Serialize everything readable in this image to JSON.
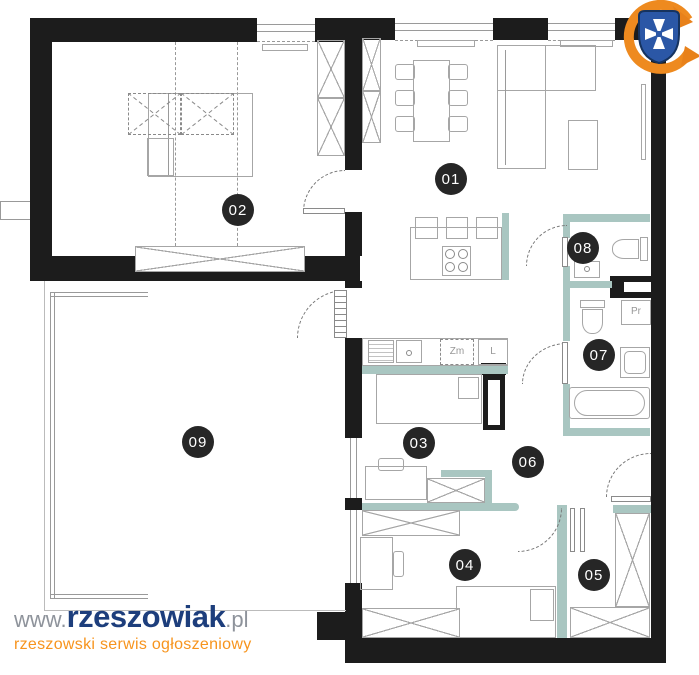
{
  "branding": {
    "www_prefix": "www.",
    "site_name": "rzeszowiak",
    "tld": ".pl",
    "tagline": "rzeszowski serwis ogłoszeniowy"
  },
  "rooms": {
    "r01": "01",
    "r02": "02",
    "r03": "03",
    "r04": "04",
    "r05": "05",
    "r06": "06",
    "r07": "07",
    "r08": "08",
    "r09": "09"
  },
  "labels": {
    "dishwasher": "Zm",
    "fridge": "L",
    "washer": "Pr"
  },
  "colors": {
    "wall": "#1c1c1c",
    "accent": "#a9c6c1",
    "badge": "#262626",
    "navy": "#1d3e7c",
    "orange": "#f7941d"
  }
}
